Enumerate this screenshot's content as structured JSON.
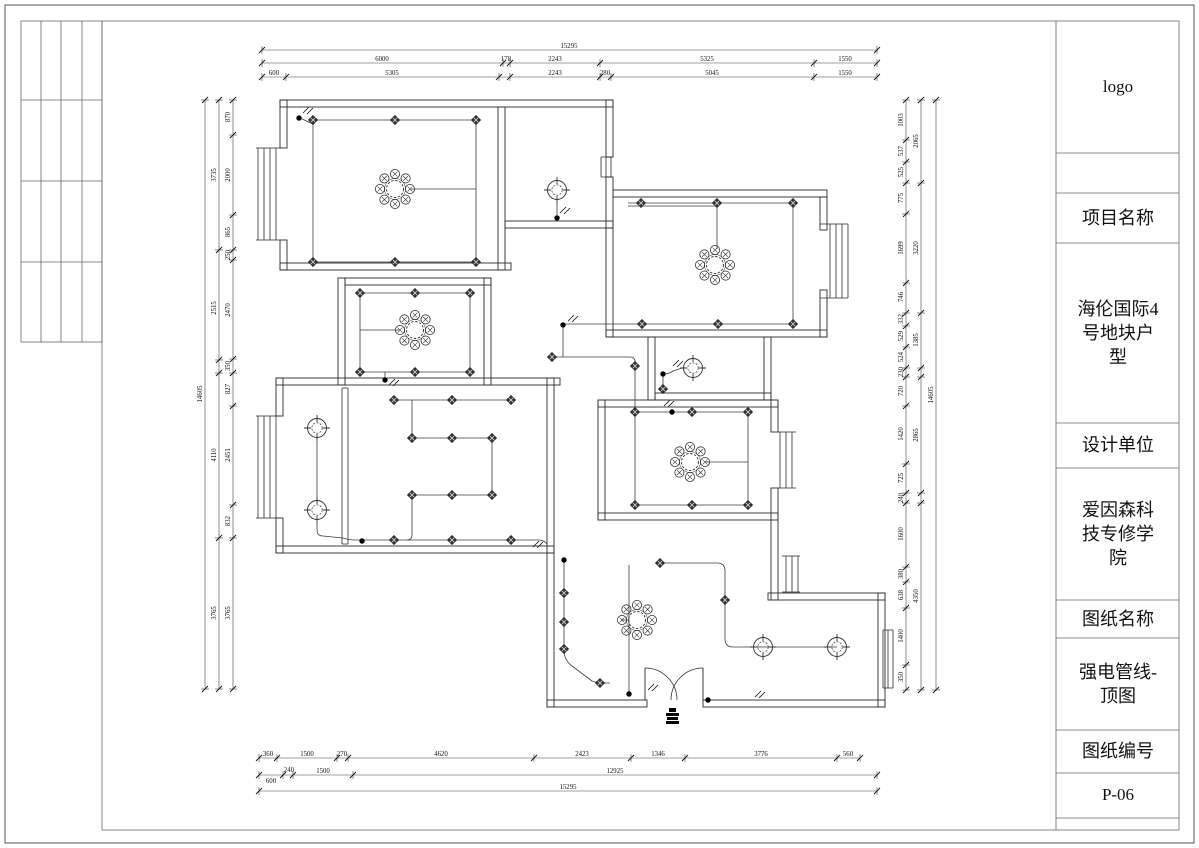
{
  "title_block": {
    "logo": "logo",
    "project_label": "项目名称",
    "project_name": "海伦国际4\n号地块户\n型",
    "designer_label": "设计单位",
    "designer_name": "爱因森科\n技专修学\n院",
    "sheet_label": "图纸名称",
    "sheet_name": "强电管线-\n顶图",
    "number_label": "图纸编号",
    "sheet_number": "P-06"
  },
  "dimensions": {
    "horizontal": [
      {
        "y": 50,
        "x1": 262,
        "x2": 877,
        "ticks": [
          262,
          877
        ],
        "labels": [
          {
            "t": "15295",
            "x": 569
          }
        ]
      },
      {
        "y": 63,
        "x1": 262,
        "x2": 877,
        "ticks": [
          262,
          503,
          510,
          600,
          814,
          877
        ],
        "labels": [
          {
            "t": "6000",
            "x": 382
          },
          {
            "t": "178",
            "x": 506
          },
          {
            "t": "2243",
            "x": 555
          },
          {
            "t": "5325",
            "x": 707
          },
          {
            "t": "1550",
            "x": 845
          }
        ]
      },
      {
        "y": 77,
        "x1": 262,
        "x2": 877,
        "ticks": [
          262,
          286,
          499,
          510,
          600,
          611,
          814,
          877
        ],
        "labels": [
          {
            "t": "600",
            "x": 274
          },
          {
            "t": "5305",
            "x": 392
          },
          {
            "t": "2243",
            "x": 555
          },
          {
            "t": "280",
            "x": 605
          },
          {
            "t": "5045",
            "x": 712
          },
          {
            "t": "1550",
            "x": 845
          }
        ]
      },
      {
        "y": 758,
        "x1": 259,
        "x2": 860,
        "ticks": [
          259,
          277,
          337,
          348,
          534,
          631,
          685,
          837,
          860
        ],
        "labels": [
          {
            "t": "360",
            "x": 268
          },
          {
            "t": "1500",
            "x": 307
          },
          {
            "t": "270",
            "x": 342
          },
          {
            "t": "4620",
            "x": 441
          },
          {
            "t": "2423",
            "x": 582
          },
          {
            "t": "1346",
            "x": 658
          },
          {
            "t": "3776",
            "x": 761
          },
          {
            "t": "560",
            "x": 848
          }
        ]
      },
      {
        "y": 775,
        "x1": 259,
        "x2": 877,
        "ticks": [
          259,
          283,
          293,
          353,
          877
        ],
        "labels": [
          {
            "t": "600",
            "x": 271,
            "dy": 10
          },
          {
            "t": "240",
            "x": 289,
            "dy": -1
          },
          {
            "t": "1500",
            "x": 323
          },
          {
            "t": "12925",
            "x": 615
          }
        ]
      },
      {
        "y": 791,
        "x1": 259,
        "x2": 877,
        "ticks": [
          259,
          877
        ],
        "labels": [
          {
            "t": "15295",
            "x": 568
          }
        ]
      }
    ],
    "vertical": [
      {
        "x": 205,
        "y1": 100,
        "y2": 689,
        "ticks": [
          100,
          689
        ],
        "labels": [
          {
            "t": "14605",
            "y": 394
          }
        ]
      },
      {
        "x": 219,
        "y1": 100,
        "y2": 689,
        "ticks": [
          100,
          250,
          360,
          373,
          538,
          689
        ],
        "labels": [
          {
            "t": "3735",
            "y": 175
          },
          {
            "t": "2515",
            "y": 308
          },
          {
            "t": "4110",
            "y": 455
          },
          {
            "t": "3765",
            "y": 613
          }
        ]
      },
      {
        "x": 233,
        "y1": 100,
        "y2": 689,
        "ticks": [
          100,
          135,
          215,
          250,
          260,
          359,
          373,
          406,
          505,
          538,
          689
        ],
        "labels": [
          {
            "t": "870",
            "y": 117
          },
          {
            "t": "2000",
            "y": 175
          },
          {
            "t": "865",
            "y": 232
          },
          {
            "t": "250",
            "y": 255
          },
          {
            "t": "2470",
            "y": 310
          },
          {
            "t": "350",
            "y": 366
          },
          {
            "t": "827",
            "y": 389
          },
          {
            "t": "2451",
            "y": 455
          },
          {
            "t": "832",
            "y": 521
          },
          {
            "t": "3765",
            "y": 613
          }
        ]
      },
      {
        "x": 906,
        "y1": 100,
        "y2": 690,
        "ticks": [
          100,
          140,
          162,
          183,
          214,
          283,
          313,
          326,
          347,
          368,
          377,
          406,
          464,
          493,
          503,
          567,
          582,
          608,
          665,
          690
        ],
        "labels": [
          {
            "t": "1003",
            "y": 120
          },
          {
            "t": "537",
            "y": 151
          },
          {
            "t": "525",
            "y": 172
          },
          {
            "t": "775",
            "y": 198
          },
          {
            "t": "1699",
            "y": 248
          },
          {
            "t": "746",
            "y": 297
          },
          {
            "t": "332",
            "y": 319
          },
          {
            "t": "529",
            "y": 336
          },
          {
            "t": "524",
            "y": 357
          },
          {
            "t": "230",
            "y": 372
          },
          {
            "t": "720",
            "y": 391
          },
          {
            "t": "1420",
            "y": 434
          },
          {
            "t": "725",
            "y": 478
          },
          {
            "t": "240",
            "y": 498
          },
          {
            "t": "1600",
            "y": 534
          },
          {
            "t": "380",
            "y": 574
          },
          {
            "t": "638",
            "y": 595
          },
          {
            "t": "1400",
            "y": 636
          },
          {
            "t": "350",
            "y": 677
          }
        ]
      },
      {
        "x": 921,
        "y1": 100,
        "y2": 690,
        "ticks": [
          100,
          183,
          313,
          368,
          377,
          493,
          503,
          690
        ],
        "labels": [
          {
            "t": "2065",
            "y": 141
          },
          {
            "t": "3220",
            "y": 248
          },
          {
            "t": "1385",
            "y": 340
          },
          {
            "t": "2865",
            "y": 435
          },
          {
            "t": "4350",
            "y": 596
          }
        ]
      },
      {
        "x": 936,
        "y1": 100,
        "y2": 690,
        "ticks": [
          100,
          690
        ],
        "labels": [
          {
            "t": "14605",
            "y": 395
          }
        ]
      }
    ]
  },
  "plan": {
    "symbols": {
      "chandeliers": [
        [
          395,
          189
        ],
        [
          415,
          330
        ],
        [
          715,
          265
        ],
        [
          690,
          462
        ],
        [
          637,
          620
        ]
      ],
      "ceiling_lamps": [
        [
          557,
          190
        ],
        [
          693,
          368
        ],
        [
          317,
          428
        ],
        [
          317,
          510
        ],
        [
          763,
          647
        ],
        [
          837,
          647
        ]
      ],
      "downlights": [
        [
          313,
          120
        ],
        [
          395,
          120
        ],
        [
          476,
          120
        ],
        [
          313,
          262
        ],
        [
          395,
          262
        ],
        [
          476,
          262
        ],
        [
          641,
          203
        ],
        [
          717,
          203
        ],
        [
          793,
          203
        ],
        [
          642,
          324
        ],
        [
          718,
          324
        ],
        [
          793,
          324
        ],
        [
          552,
          357
        ],
        [
          635,
          366
        ],
        [
          663,
          389
        ],
        [
          635,
          412
        ],
        [
          692,
          412
        ],
        [
          748,
          412
        ],
        [
          635,
          505
        ],
        [
          692,
          505
        ],
        [
          748,
          505
        ],
        [
          360,
          293
        ],
        [
          415,
          293
        ],
        [
          470,
          293
        ],
        [
          360,
          372
        ],
        [
          415,
          372
        ],
        [
          470,
          372
        ],
        [
          394,
          400
        ],
        [
          452,
          400
        ],
        [
          511,
          400
        ],
        [
          412,
          438
        ],
        [
          452,
          438
        ],
        [
          492,
          438
        ],
        [
          412,
          495
        ],
        [
          452,
          495
        ],
        [
          492,
          495
        ],
        [
          394,
          540
        ],
        [
          452,
          540
        ],
        [
          511,
          540
        ],
        [
          564,
          593
        ],
        [
          564,
          622
        ],
        [
          564,
          649
        ],
        [
          600,
          683
        ],
        [
          660,
          563
        ],
        [
          725,
          600
        ]
      ],
      "junction_dots": [
        [
          299,
          118
        ],
        [
          557,
          218
        ],
        [
          563,
          325
        ],
        [
          663,
          374
        ],
        [
          672,
          412
        ],
        [
          385,
          380
        ],
        [
          362,
          541
        ],
        [
          564,
          560
        ],
        [
          629,
          694
        ],
        [
          708,
          700
        ]
      ],
      "switches": [
        [
          303,
          110
        ],
        [
          560,
          210
        ],
        [
          568,
          318
        ],
        [
          673,
          363
        ],
        [
          664,
          403
        ],
        [
          389,
          382
        ],
        [
          533,
          544
        ],
        [
          648,
          687
        ],
        [
          755,
          694
        ]
      ]
    }
  }
}
